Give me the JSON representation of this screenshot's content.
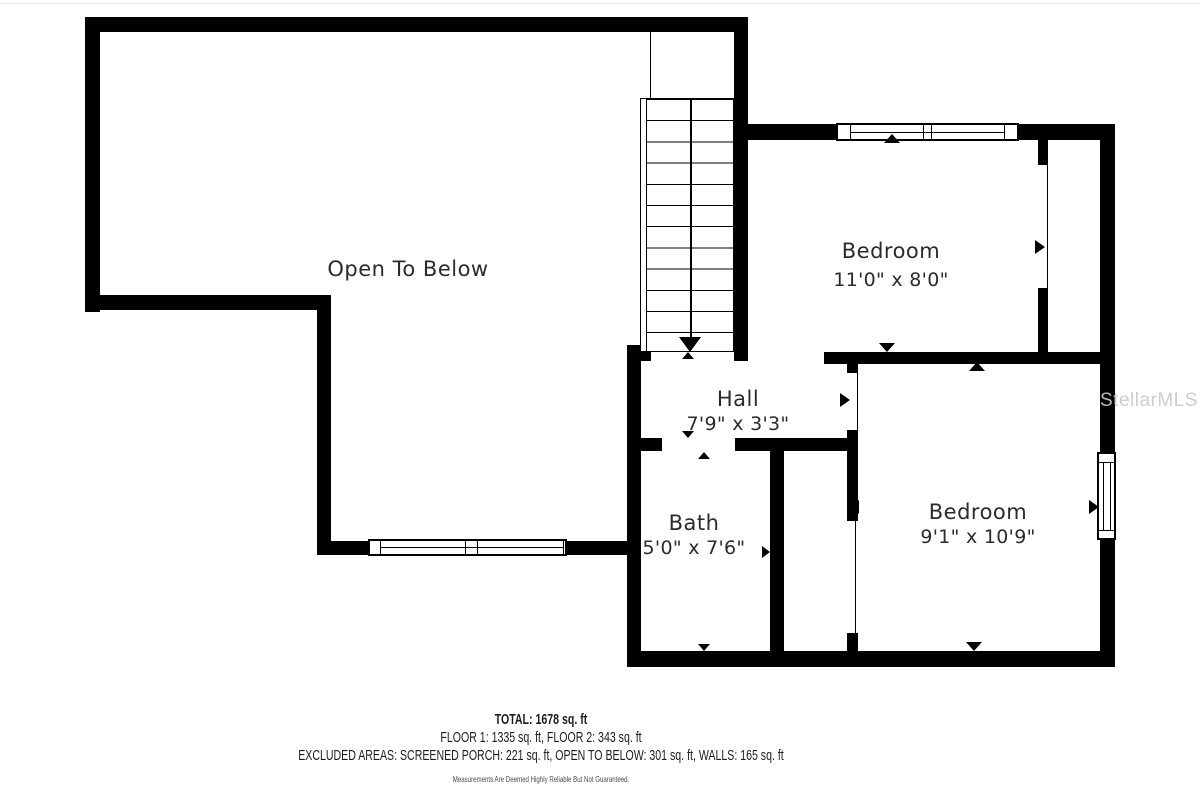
{
  "rooms": {
    "open_to_below": {
      "label": "Open To Below"
    },
    "bedroom_top": {
      "label": "Bedroom",
      "dims": "11'0\" x 8'0\""
    },
    "hall": {
      "label": "Hall",
      "dims": "7'9\" x 3'3\""
    },
    "bath": {
      "label": "Bath",
      "dims": "5'0\" x 7'6\""
    },
    "bedroom_bottom": {
      "label": "Bedroom",
      "dims": "9'1\" x 10'9\""
    }
  },
  "footer": {
    "total": "TOTAL: 1678 sq. ft",
    "floors": "FLOOR 1: 1335 sq. ft, FLOOR 2: 343 sq. ft",
    "excluded": "EXCLUDED AREAS: SCREENED PORCH: 221 sq. ft, OPEN TO BELOW: 301 sq. ft, WALLS: 165 sq. ft",
    "disclaimer": "Measurements Are Deemed Highly Reliable But Not Guaranteed."
  },
  "watermark": {
    "text": "StellarMLS"
  },
  "stairs": {
    "direction": "down"
  },
  "colors": {
    "wall": "#000000",
    "label_text": "#2b2b2b",
    "footer_text": "#1c1c1c",
    "disclaimer_text": "#4a4a4a",
    "watermark": "#c9c9c9"
  }
}
